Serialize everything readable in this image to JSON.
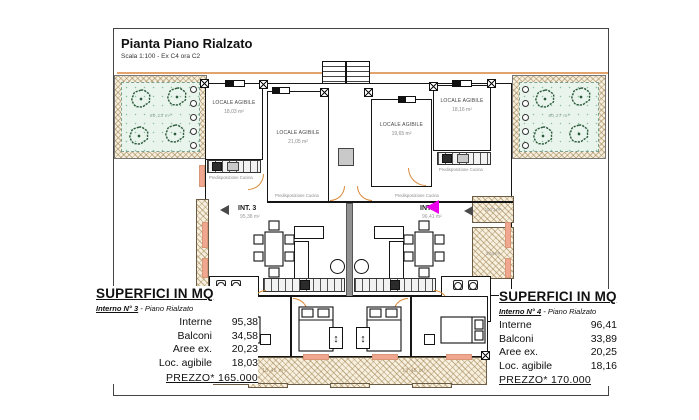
{
  "title_block": {
    "title": "Pianta Piano Rialzato",
    "subtitle": "Scala 1:100 - Ex C4 ora C2"
  },
  "colors": {
    "boundary_tan": "#e2a46c",
    "arrow_magenta": "#ea00ea",
    "sill_salmon": "#f1a78f",
    "garden_green": "#e9f4ec"
  },
  "icons": {
    "shutter_arrow": "↕"
  },
  "rooms": {
    "a": {
      "name": "LOCALE AGIBILE",
      "area": "18,03 m²"
    },
    "b": {
      "name": "LOCALE AGIBILE",
      "area": "21,05 m²"
    },
    "c": {
      "name": "LOCALE AGIBILE",
      "area": "19,65 m²"
    },
    "d": {
      "name": "LOCALE AGIBILE",
      "area": "18,16 m²"
    }
  },
  "units": {
    "int3": {
      "label": "INT. 3",
      "area": "95,38 m²"
    },
    "int4": {
      "label": "INT. 4",
      "area": "96,41 m²"
    }
  },
  "annotations": {
    "kitchen": "Predisposizione Cucina",
    "wc": "wc",
    "garden_left_area": "80,23 m²",
    "garden_right_area": "80,27 m²",
    "balcony_left_area": "13,45 m²",
    "balcony_right_area": "13,45 m²",
    "terrace_top_area": "10,71 m²",
    "terrace_mid_area": "2,64 m²"
  },
  "left_panel": {
    "heading": "SUPERFICI IN MQ",
    "unit": "Interno N° 3",
    "unit_suffix": " - Piano Rialzato",
    "rows": [
      {
        "label": "Interne",
        "value": "95,38"
      },
      {
        "label": "Balconi",
        "value": "34,58"
      },
      {
        "label": "Aree ex.",
        "value": "20,23"
      },
      {
        "label": "Loc. agibile",
        "value": "18,03"
      }
    ],
    "price": "PREZZO* 165.000"
  },
  "right_panel": {
    "heading": "SUPERFICI IN MQ",
    "unit": "Interno N° 4",
    "unit_suffix": " - Piano Rialzato",
    "rows": [
      {
        "label": "Interne",
        "value": "96,41"
      },
      {
        "label": "Balconi",
        "value": "33,89"
      },
      {
        "label": "Aree ex.",
        "value": "20,25"
      },
      {
        "label": "Loc. agibile",
        "value": "18,16"
      }
    ],
    "price": "PREZZO* 170.000"
  }
}
